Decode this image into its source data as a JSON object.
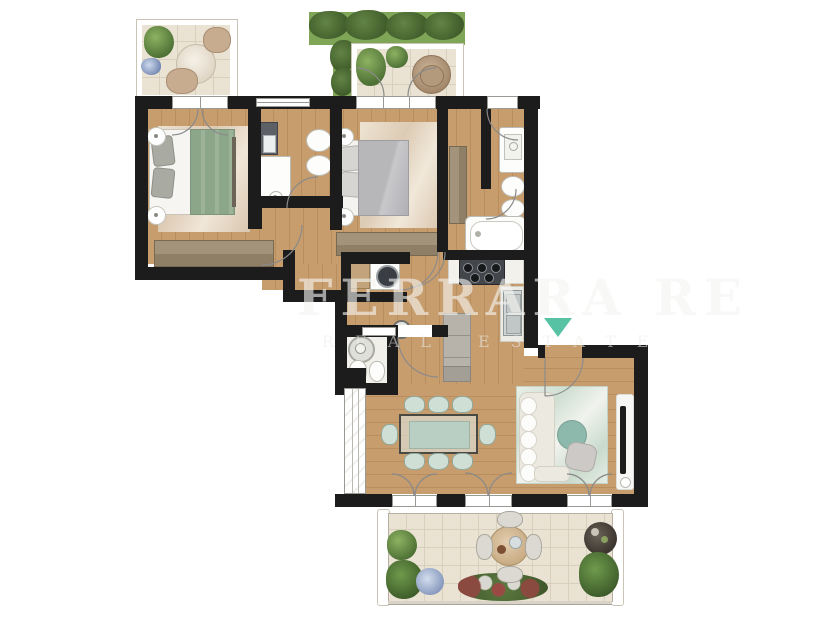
{
  "watermark": {
    "title": "FERRARA RE",
    "subtitle": "REAL ESTATE"
  },
  "entrance": {
    "marker": "teal-triangle-down"
  },
  "colors": {
    "wall": "#1c1c1c",
    "wood": "#c79d6e",
    "wood_dark": "#b98e5e",
    "tile": "#eae3d3",
    "tile_line": "#d8d0bc",
    "grass": "#7fa557",
    "rug_beige": "#e8dcc8",
    "rug_green": "#d6e3d8",
    "bed_green": "#8ba689",
    "duvet_gray": "#b7b7ba",
    "furn_brown": "#9a8a6e",
    "chair_sage": "#cfdfd5",
    "sofa_cream": "#ece9e0",
    "teal": "#57c3a4",
    "coffee_teal": "#8cb9ac"
  }
}
